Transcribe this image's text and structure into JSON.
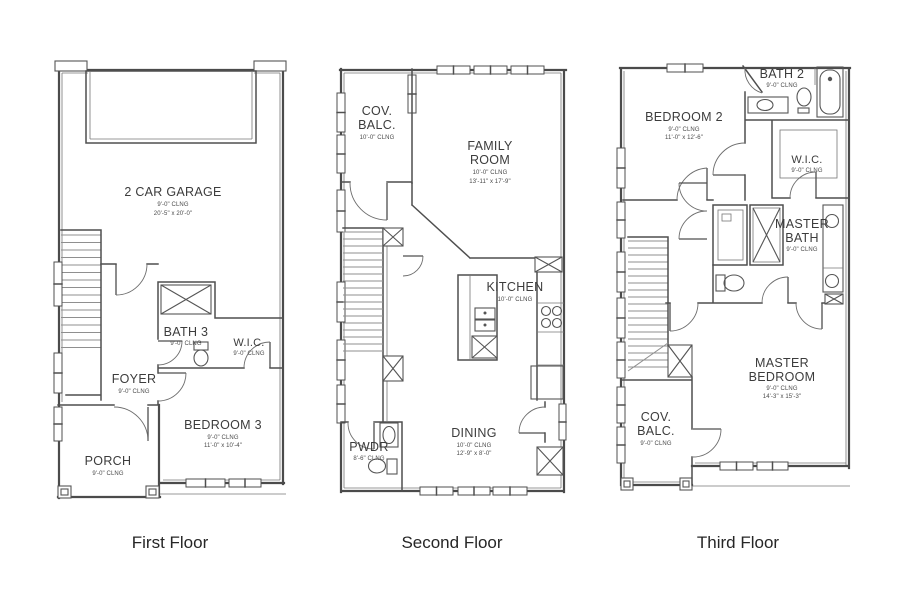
{
  "palette": {
    "wall": "#4b4b4b",
    "stair": "#8f8f8f",
    "text": "#3c3c3c",
    "background": "#ffffff"
  },
  "floors": [
    {
      "caption": "First Floor",
      "rooms": {
        "garage": {
          "name": "2 CAR GARAGE",
          "clng": "9'-0\" CLNG",
          "dims": "20'-5\" x 20'-0\""
        },
        "bath3": {
          "name": "BATH 3",
          "clng": "9'-0\" CLNG"
        },
        "wic": {
          "name": "W.I.C.",
          "clng": "9'-0\" CLNG"
        },
        "foyer": {
          "name": "FOYER",
          "clng": "9'-0\" CLNG"
        },
        "bedroom3": {
          "name": "BEDROOM 3",
          "clng": "9'-0\" CLNG",
          "dims": "11'-0\" x 10'-4\""
        },
        "porch": {
          "name": "PORCH",
          "clng": "9'-0\" CLNG"
        }
      }
    },
    {
      "caption": "Second Floor",
      "rooms": {
        "cov_balc": {
          "name1": "COV.",
          "name2": "BALC.",
          "clng": "10'-0\" CLNG"
        },
        "family": {
          "name1": "FAMILY",
          "name2": "ROOM",
          "clng": "10'-0\" CLNG",
          "dims": "13'-11\" x 17'-9\""
        },
        "kitchen": {
          "name": "KITCHEN",
          "clng": "10'-0\" CLNG"
        },
        "dining": {
          "name": "DINING",
          "clng": "10'-0\" CLNG",
          "dims": "12'-9\" x 8'-0\""
        },
        "pwdr": {
          "name": "PWDR",
          "clng": "8'-6\" CLNG"
        }
      }
    },
    {
      "caption": "Third Floor",
      "rooms": {
        "bedroom2": {
          "name": "BEDROOM 2",
          "clng": "9'-0\" CLNG",
          "dims": "11'-0\" x 12'-6\""
        },
        "bath2": {
          "name": "BATH 2",
          "clng": "9'-0\" CLNG"
        },
        "wic": {
          "name": "W.I.C.",
          "clng": "9'-0\" CLNG"
        },
        "master_bath": {
          "name1": "MASTER",
          "name2": "BATH",
          "clng": "9'-0\" CLNG"
        },
        "master_bedroom": {
          "name1": "MASTER",
          "name2": "BEDROOM",
          "clng": "9'-0\" CLNG",
          "dims": "14'-3\" x 15'-3\""
        },
        "cov_balc": {
          "name1": "COV.",
          "name2": "BALC.",
          "clng": "9'-0\" CLNG"
        }
      }
    }
  ]
}
